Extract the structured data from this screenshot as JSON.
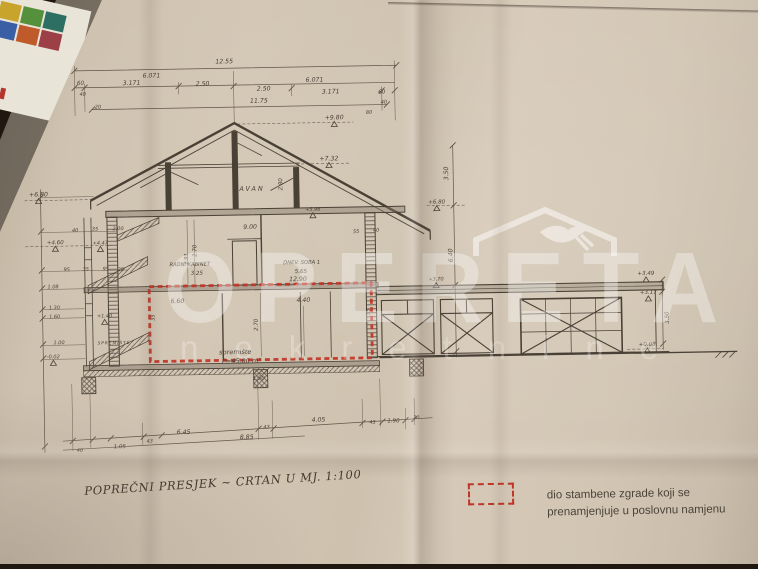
{
  "scene": {
    "background_color": "#201711",
    "paper_color": "#cfc2b0",
    "ink_color": "#4a4136",
    "highlight_red": "#bf3527",
    "watermark_white": "rgba(255,255,255,0.34)"
  },
  "corner_object": {
    "colors": [
      "#c9a42c",
      "#55903c",
      "#2e6f63",
      "#3a5fa4",
      "#bf5b2a",
      "#9c3f46"
    ]
  },
  "watermark": {
    "brand": "OPERETA",
    "subtitle": "nekretnine",
    "logo_icon": "roof-with-swallow"
  },
  "caption": {
    "text": "POPREČNI PRESJEK ~ CRTAN U MJ. 1:100"
  },
  "legend": {
    "swatch": "red-dashed-rectangle",
    "line1": "dio stambene zgrade koji se",
    "line2": "prenamjenjuje u poslovnu namjenu"
  },
  "drawing": {
    "scale": "1:100",
    "highlight": {
      "room": "spremište",
      "area_label": "P=45,00 m²"
    },
    "annotations": [
      {
        "t": "12.55",
        "x": 228,
        "y": 62
      },
      {
        "t": "6.071",
        "x": 155,
        "y": 75
      },
      {
        "t": "6.071",
        "x": 318,
        "y": 82
      },
      {
        "t": "60",
        "x": 84,
        "y": 81,
        "s": 5.5
      },
      {
        "t": "3.171",
        "x": 135,
        "y": 82
      },
      {
        "t": "2.50",
        "x": 206,
        "y": 84
      },
      {
        "t": "2.50",
        "x": 267,
        "y": 90
      },
      {
        "t": "3.171",
        "x": 334,
        "y": 94
      },
      {
        "t": "60",
        "x": 385,
        "y": 95,
        "s": 5.5
      },
      {
        "t": "40",
        "x": 86,
        "y": 92,
        "s": 5
      },
      {
        "t": "20",
        "x": 101,
        "y": 105,
        "s": 5
      },
      {
        "t": "11.75",
        "x": 262,
        "y": 102
      },
      {
        "t": "40",
        "x": 387,
        "y": 105,
        "s": 5
      },
      {
        "t": "80",
        "x": 372,
        "y": 115,
        "s": 5
      },
      {
        "t": "+9.80",
        "x": 337,
        "y": 120,
        "lvl": true
      },
      {
        "t": "+7.32",
        "x": 331,
        "y": 161,
        "lvl": true
      },
      {
        "t": "TAVAN",
        "x": 251,
        "y": 190,
        "s": 6.5,
        "sp": 2
      },
      {
        "t": "2.80",
        "x": 284,
        "y": 184,
        "r": -90,
        "s": 5.5
      },
      {
        "t": "+6.80",
        "x": 40,
        "y": 192,
        "lvl": true
      },
      {
        "t": "+5.96",
        "x": 314,
        "y": 211,
        "s": 5,
        "lvl": true
      },
      {
        "t": "55",
        "x": 357,
        "y": 234,
        "s": 5
      },
      {
        "t": "40",
        "x": 377,
        "y": 233,
        "s": 5
      },
      {
        "t": "9.00",
        "x": 251,
        "y": 228
      },
      {
        "t": "2.70",
        "x": 197,
        "y": 249,
        "r": -90,
        "s": 5.5
      },
      {
        "t": "2.93",
        "x": 188,
        "y": 257,
        "r": -90,
        "s": 5
      },
      {
        "t": "RADNI KABINET",
        "x": 190,
        "y": 264,
        "s": 5.2
      },
      {
        "t": "3.25",
        "x": 197,
        "y": 273,
        "s": 5.5
      },
      {
        "t": "DNEV. SOBA 1",
        "x": 302,
        "y": 264,
        "s": 5.2
      },
      {
        "t": "5.65",
        "x": 301,
        "y": 273,
        "s": 5.5
      },
      {
        "t": "12.90",
        "x": 298,
        "y": 281
      },
      {
        "t": "6.60",
        "x": 177,
        "y": 301
      },
      {
        "t": "4.40",
        "x": 303,
        "y": 302
      },
      {
        "t": "2.70",
        "x": 257,
        "y": 324,
        "r": -90,
        "s": 5.5
      },
      {
        "t": "35",
        "x": 154,
        "y": 315,
        "r": -90,
        "s": 5
      },
      {
        "t": "35",
        "x": 369,
        "y": 313,
        "r": -90,
        "s": 5
      },
      {
        "t": "spremište",
        "x": 234,
        "y": 353,
        "s": 6.5
      },
      {
        "t": "P=45,00 m²",
        "x": 240,
        "y": 362,
        "s": 6.5
      },
      {
        "t": "SPREMIŠTE",
        "x": 113,
        "y": 341,
        "s": 4.3,
        "sp": 1
      },
      {
        "t": "1.50",
        "x": 257,
        "y": 379,
        "s": 5.5
      },
      {
        "t": "40",
        "x": 76,
        "y": 228,
        "s": 5
      },
      {
        "t": "35",
        "x": 96,
        "y": 227,
        "s": 5
      },
      {
        "t": "2.00",
        "x": 119,
        "y": 227,
        "s": 5
      },
      {
        "t": "+4.60",
        "x": 56,
        "y": 240,
        "s": 5.5,
        "lvl": true
      },
      {
        "t": "+4.47",
        "x": 101,
        "y": 241,
        "s": 5,
        "lvl": true
      },
      {
        "t": "95",
        "x": 67,
        "y": 267,
        "s": 5
      },
      {
        "t": "35",
        "x": 86,
        "y": 267,
        "s": 5
      },
      {
        "t": "95",
        "x": 106,
        "y": 267,
        "s": 5
      },
      {
        "t": "25",
        "x": 121,
        "y": 268,
        "s": 5
      },
      {
        "t": "1.08",
        "x": 53,
        "y": 284,
        "s": 5
      },
      {
        "t": "1.30",
        "x": 54,
        "y": 305,
        "s": 5
      },
      {
        "t": "1.60",
        "x": 54,
        "y": 314,
        "s": 5
      },
      {
        "t": "+1.40",
        "x": 104,
        "y": 314,
        "s": 5,
        "lvl": true
      },
      {
        "t": "1.00",
        "x": 58,
        "y": 340,
        "s": 5
      },
      {
        "t": "-0.02",
        "x": 52,
        "y": 354,
        "s": 5,
        "lvl": true
      },
      {
        "t": "3.50",
        "x": 450,
        "y": 176,
        "r": -90
      },
      {
        "t": "+6.80",
        "x": 438,
        "y": 206,
        "s": 5.5,
        "lvl": true
      },
      {
        "t": "6.40",
        "x": 453,
        "y": 258,
        "r": -90
      },
      {
        "t": "+3.70",
        "x": 436,
        "y": 283,
        "s": 5,
        "lvl": true
      },
      {
        "t": "+3.49",
        "x": 646,
        "y": 281,
        "s": 5.5,
        "lvl": true
      },
      {
        "t": "+3.17",
        "x": 648,
        "y": 300,
        "s": 5.5,
        "lvl": true
      },
      {
        "t": "3.50",
        "x": 668,
        "y": 324,
        "r": -90,
        "s": 5.5
      },
      {
        "t": "+0.08",
        "x": 646,
        "y": 352,
        "s": 5.5,
        "lvl": true
      },
      {
        "t": "40",
        "x": 77,
        "y": 448,
        "s": 5
      },
      {
        "t": "1.05",
        "x": 117,
        "y": 445,
        "s": 5.5
      },
      {
        "t": "43",
        "x": 147,
        "y": 440,
        "s": 5
      },
      {
        "t": "6.45",
        "x": 181,
        "y": 432
      },
      {
        "t": "8.85",
        "x": 244,
        "y": 438
      },
      {
        "t": "43",
        "x": 264,
        "y": 428,
        "s": 5
      },
      {
        "t": "4.05",
        "x": 316,
        "y": 422
      },
      {
        "t": "43",
        "x": 370,
        "y": 425,
        "s": 5
      },
      {
        "t": "1.90",
        "x": 391,
        "y": 424,
        "s": 5.5
      },
      {
        "t": "20",
        "x": 414,
        "y": 421,
        "s": 5
      }
    ]
  }
}
